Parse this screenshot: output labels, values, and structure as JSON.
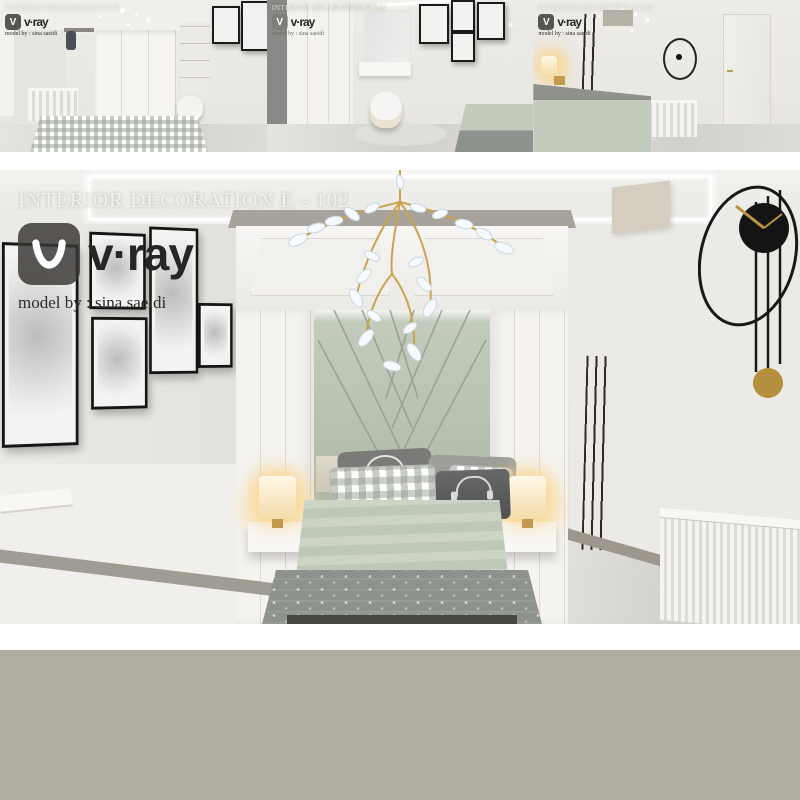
{
  "watermark": {
    "title": "INTERIOR DECORATION E - 102",
    "brand": "v·ray",
    "credit": "model by : sina saeidi",
    "logo_glyph": "V"
  },
  "thumbnails": [
    {
      "title": "INTERIOR DECORATION E-102",
      "brand": "v·ray",
      "credit": "model by : sina saeidi",
      "logo_glyph": "V"
    },
    {
      "title": "INTERIOR DECORATION E-102",
      "brand": "v·ray",
      "credit": "model by : sina saeidi",
      "logo_glyph": "V"
    },
    {
      "title": "INTERIOR DECORATION E-102",
      "brand": "v·ray",
      "credit": "model by : sina saeidi",
      "logo_glyph": "V"
    }
  ],
  "colors": {
    "sage_headboard": "#b4bfae",
    "sage_duvet": "#c6cfc0",
    "blanket_gray": "#8e928d",
    "gold_accent": "#c9a44f",
    "lamp_glow": "#f7dca4",
    "wall": "#e9e7e3",
    "frame_black": "#1a1a1a",
    "footer_gray": "#b0aca1"
  }
}
